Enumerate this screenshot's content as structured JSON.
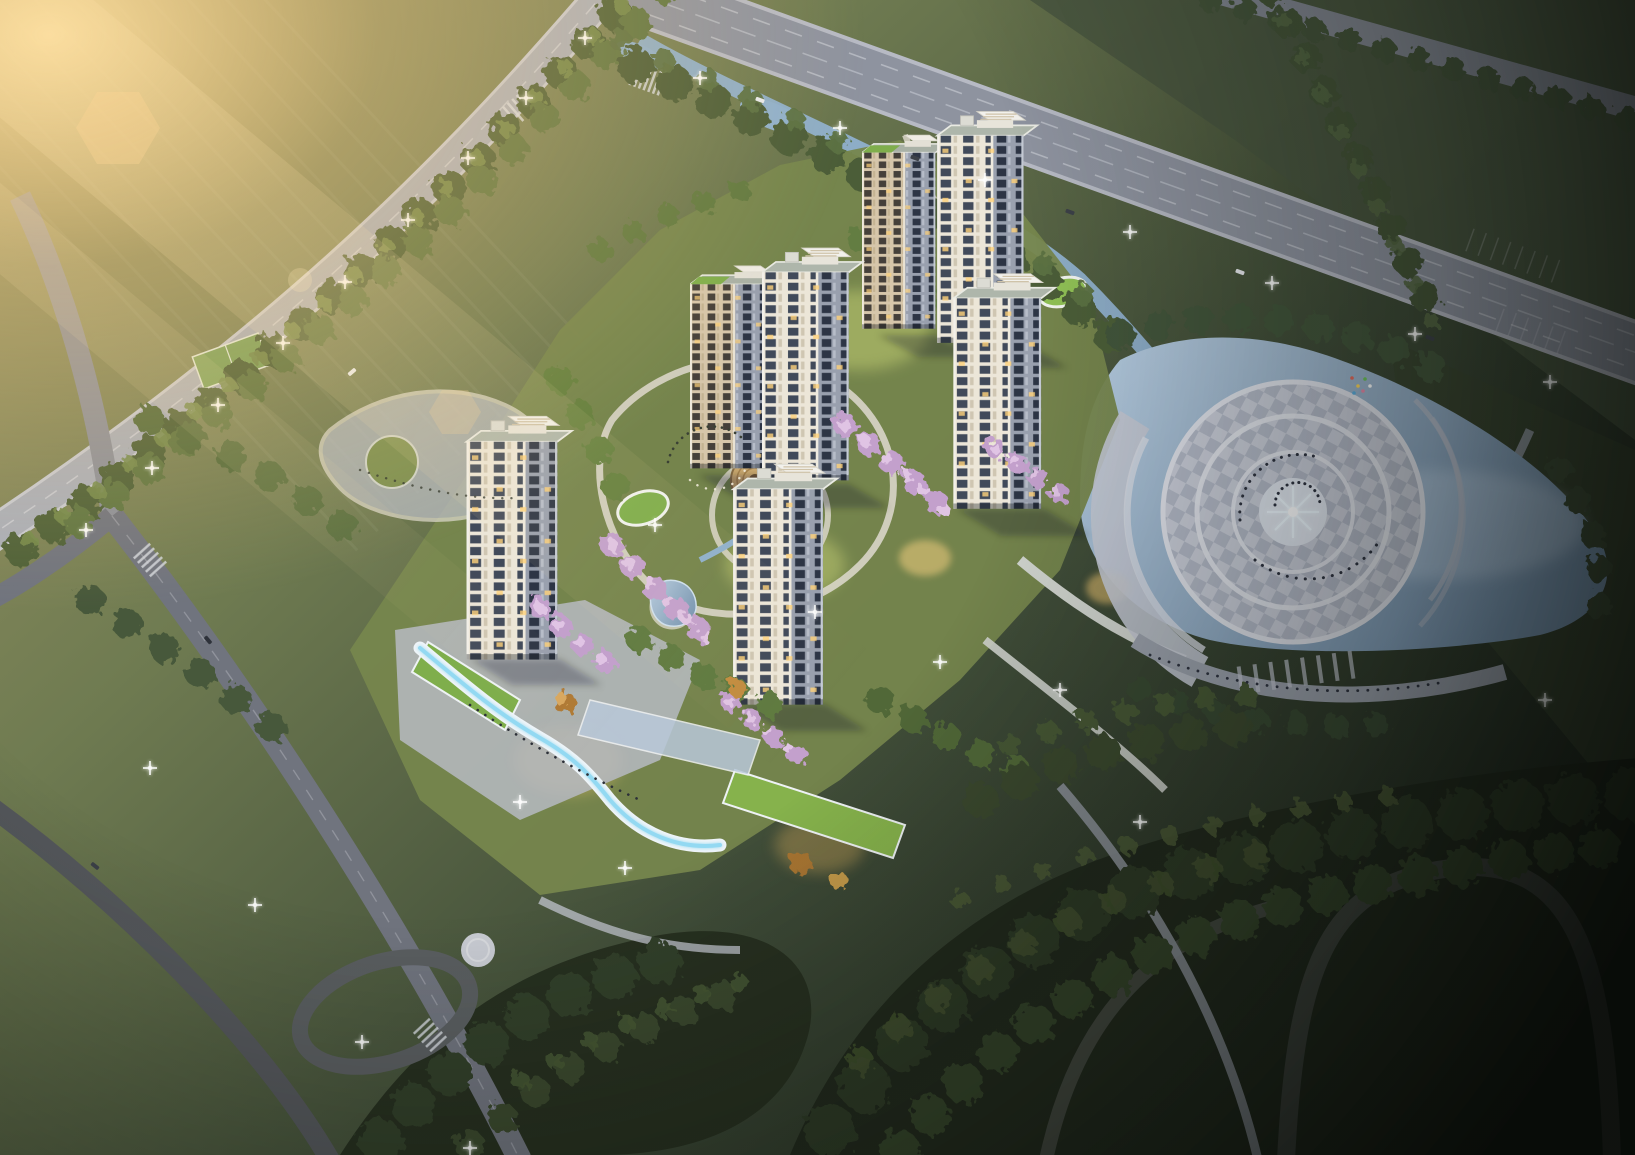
{
  "image": {
    "kind": "architectural aerial rendering",
    "visible_text": "none",
    "caption": "Dusk aerial rendering of a residential compound: seven cream high-rise towers with dark window bands around a landscaped courtyard with winding paths, cherry blossoms, ponds and a round timber amphitheatre; an S-shaped illuminated entrance canopy with green roofs at lower left; tree-lined boulevards with street lights and cars; a stream widening into a lake with a circular checkered fountain plaza at right; dark woodland and curving park roads below; golden sun flare from the upper left."
  },
  "scene": {
    "sun_flare": {
      "position": "top-left",
      "color": "#ffe0a0"
    },
    "towers": {
      "count": 7,
      "facade": "#ece6d8",
      "window_band": "#414a5a",
      "shaded_face": "#99a0ae",
      "beige_facade": "#d6c6aa",
      "roof": "#aeb6ab",
      "penthouse": "#f2f1ec",
      "lit_window": "#ffd27a",
      "green_roof": "#7fae4c"
    },
    "landscape": {
      "field_light": "#9c9565",
      "field_mid": "#6f7b51",
      "field_dark": "#3f4c38",
      "field_deep": "#20281e",
      "woodland": "#222a1d",
      "tree_light": "#74894c",
      "tree_mid": "#4e6039",
      "lawn_lit": "#c6d173",
      "blossom": "#e0c4e4",
      "autumn": "#b07a35"
    },
    "water": {
      "lake_light": "#b6cce0",
      "lake_deep": "#7b98b4",
      "stream": "#8fb0cc"
    },
    "hardscape": {
      "boulevard": "#8e939f",
      "curb": "#b7bac4",
      "minor_road": "#70747e",
      "dark_road": "#41463f",
      "path": "#d9d6c9",
      "plaza_light": "#c9cdd8",
      "plaza_dark": "#b2b8c6",
      "promenade": "#9aa0ab"
    },
    "features": {
      "entrance_canopy": {
        "ribbon": "#eef4f8",
        "glow": "#8fd8f2"
      },
      "fountain_plaza": {
        "center": "#dfe5ee",
        "spray": "#eef8ff",
        "people": "#2e3340"
      },
      "amphitheatre": {
        "deck": "#c9a86f",
        "rings": "#a8854f"
      },
      "street_light": "#ffffff",
      "car_light": "#e8eaee",
      "car_dark": "#3c4148"
    }
  }
}
